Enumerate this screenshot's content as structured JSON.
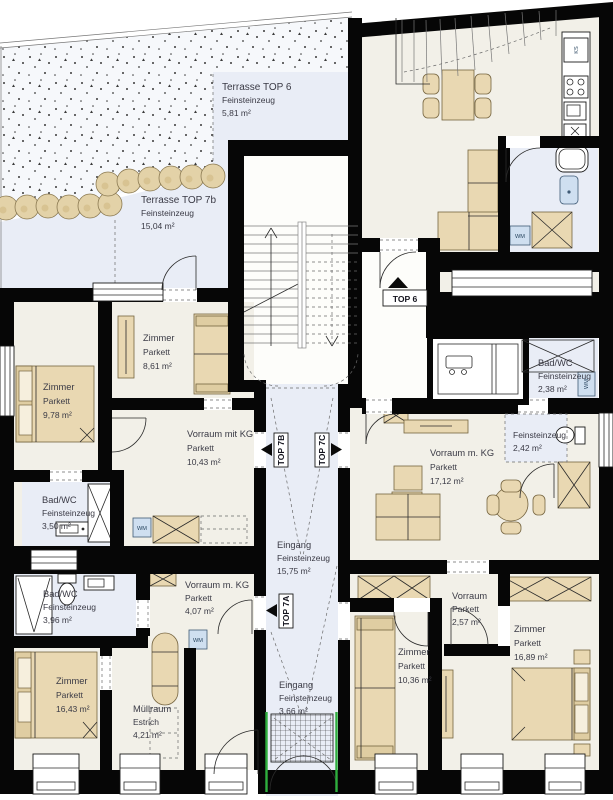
{
  "colors": {
    "wall": "#060606",
    "room_floor": "#f2f0e8",
    "wet_floor": "#e9edf6",
    "furniture": "#e9d8b2",
    "appliance": "#cfdff0",
    "accent_green": "#2fae3e"
  },
  "rooms": [
    {
      "name": "Terrasse TOP 6",
      "material": "Feinsteinzeug",
      "area": "5,81 m²"
    },
    {
      "name": "Terrasse TOP 7b",
      "material": "Feinsteinzeug",
      "area": "15,04 m²"
    },
    {
      "name": "Zimmer",
      "material": "Parkett",
      "area": "8,61 m²"
    },
    {
      "name": "Zimmer",
      "material": "Parkett",
      "area": "9,78 m²"
    },
    {
      "name": "Vorraum mit KG",
      "material": "Parkett",
      "area": "10,43 m²"
    },
    {
      "name": "Bad/WC",
      "material": "Feinsteinzeug",
      "area": "3,50 m²"
    },
    {
      "name": "Vorraum m. KG",
      "material": "Parkett",
      "area": "17,12 m²"
    },
    {
      "name": "Bad/WC",
      "material": "Feinsteinzeug",
      "area": "2,38 m²"
    },
    {
      "name": "",
      "material": "Feinsteinzeug",
      "area": "2,42 m²"
    },
    {
      "name": "Eingang",
      "material": "Feinsteinzeug",
      "area": "15,75 m²"
    },
    {
      "name": "Eingang",
      "material": "Feinsteinzeug",
      "area": "3,66 m²"
    },
    {
      "name": "Bad/WC",
      "material": "Feinsteinzeug",
      "area": "3,96 m²"
    },
    {
      "name": "Zimmer",
      "material": "Parkett",
      "area": "16,43 m²"
    },
    {
      "name": "Müllraum",
      "material": "Estrich",
      "area": "4,21 m²"
    },
    {
      "name": "Vorraum m. KG",
      "material": "Parkett",
      "area": "4,07 m²"
    },
    {
      "name": "Zimmer",
      "material": "Parkett",
      "area": "10,36 m²"
    },
    {
      "name": "Vorraum",
      "material": "Parkett",
      "area": "2,57 m²"
    },
    {
      "name": "Zimmer",
      "material": "Parkett",
      "area": "16,89 m²"
    }
  ],
  "markers": {
    "top6": "TOP 6",
    "top7a": "TOP 7A",
    "top7b": "TOP 7B",
    "top7c": "TOP 7C"
  },
  "appliances": {
    "washing_machine": "WM",
    "fridge": "KS"
  }
}
